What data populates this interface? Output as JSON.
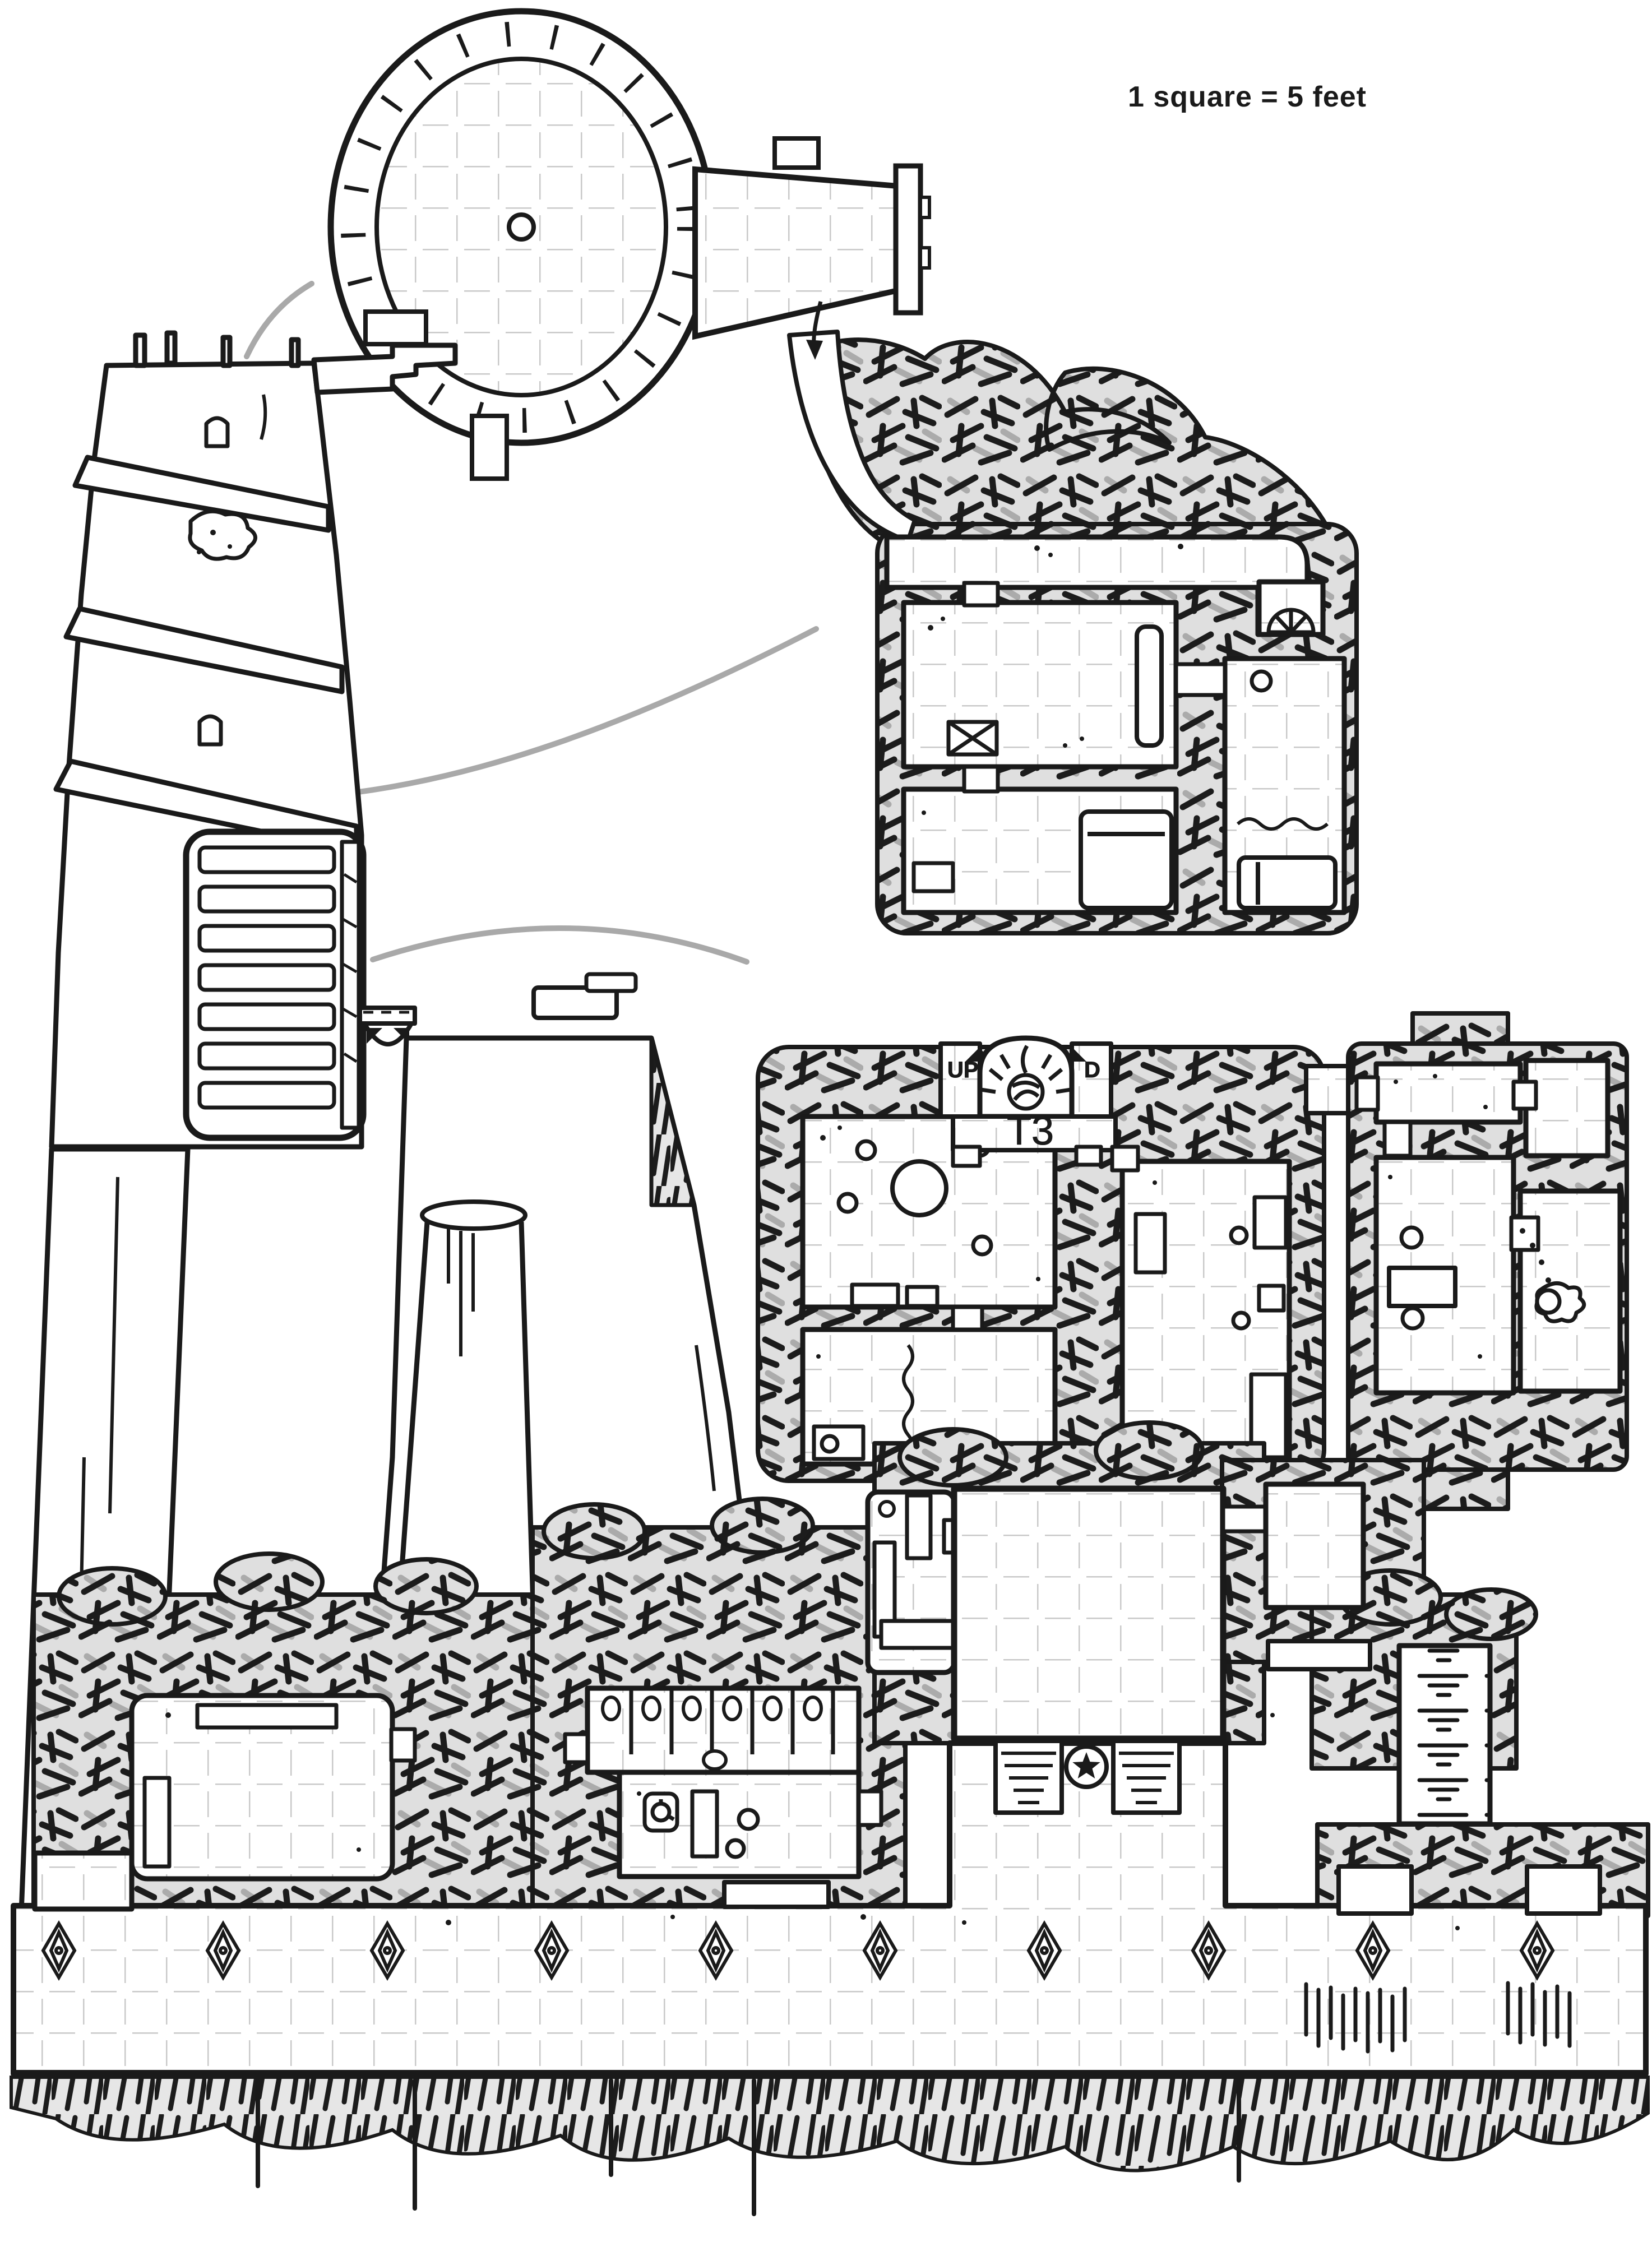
{
  "scale_note": {
    "text": "1 square = 5 feet"
  },
  "labels": {
    "stair_room": "T3",
    "stairs_up": "UP",
    "stairs_down": "D"
  },
  "palette": {
    "ink": "#1a1a1a",
    "paper": "#ffffff",
    "rubble_fill": "#dfdfdf",
    "rubble_gray_stroke": "#ababab",
    "grid_gray": "#c9c9c9",
    "leader_gray": "#a9a9a9"
  },
  "grid": {
    "square_feet": 5
  },
  "regions": [
    "tower-roof-plan-with-walkway",
    "tower-elevation",
    "bridge-and-cliff-plateau",
    "upper-level-dungeon",
    "t3-stair-level-dungeon",
    "east-annex-dungeon",
    "ground-level-halls",
    "stable-with-stalls",
    "terrace-with-diamond-pillars",
    "cliff-edge"
  ],
  "icons": [
    "star-emblem",
    "hearth-fire",
    "arched-alcove",
    "well-crank",
    "diamond-pillar",
    "round-table",
    "stool",
    "bed",
    "crate",
    "stairs-down",
    "water-pool",
    "reeds",
    "entry-arrow"
  ]
}
